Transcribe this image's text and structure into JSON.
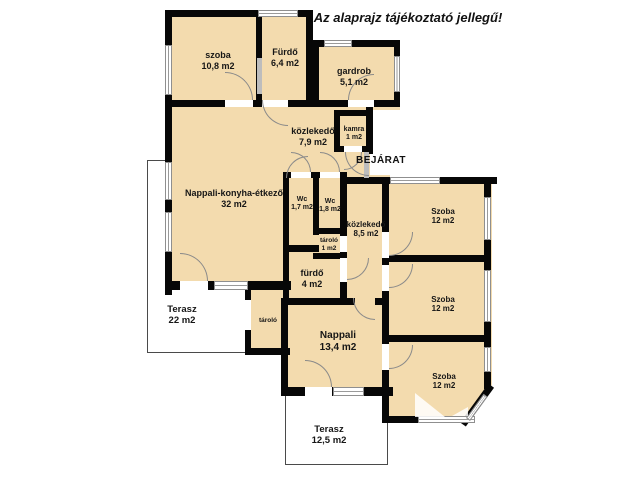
{
  "title": "Az alaprajz tájékoztató jellegű!",
  "entrance_label": "BEJÁRAT",
  "colors": {
    "room_fill": "#f3dbae",
    "wall": "#070707",
    "window_line": "#9a9a9a",
    "terrace_outline": "#4a4a4a",
    "background": "#ffffff"
  },
  "rooms": [
    {
      "name": "szoba",
      "area": "10,8 m2"
    },
    {
      "name": "Fürdő",
      "area": "6,4 m2"
    },
    {
      "name": "gardrob",
      "area": "5,1 m2"
    },
    {
      "name": "közlekedő",
      "area": "7,9 m2"
    },
    {
      "name": "kamra",
      "area": "1 m2"
    },
    {
      "name": "Nappali-konyha-étkező",
      "area": "32 m2"
    },
    {
      "name": "Wc",
      "area": "1,7 m2"
    },
    {
      "name": "Wc",
      "area": "1,8 m2"
    },
    {
      "name": "közlekedő",
      "area": "8,5 m2"
    },
    {
      "name": "Szoba",
      "area": "12 m2"
    },
    {
      "name": "tároló",
      "area": "1 m2"
    },
    {
      "name": "fürdő",
      "area": "4 m2"
    },
    {
      "name": "Szoba",
      "area": "12 m2"
    },
    {
      "name": "Terasz",
      "area": "22 m2"
    },
    {
      "name": "tároló",
      "area": ""
    },
    {
      "name": "Nappali",
      "area": "13,4 m2"
    },
    {
      "name": "Szoba",
      "area": "12 m2"
    },
    {
      "name": "Terasz",
      "area": "12,5 m2"
    }
  ]
}
